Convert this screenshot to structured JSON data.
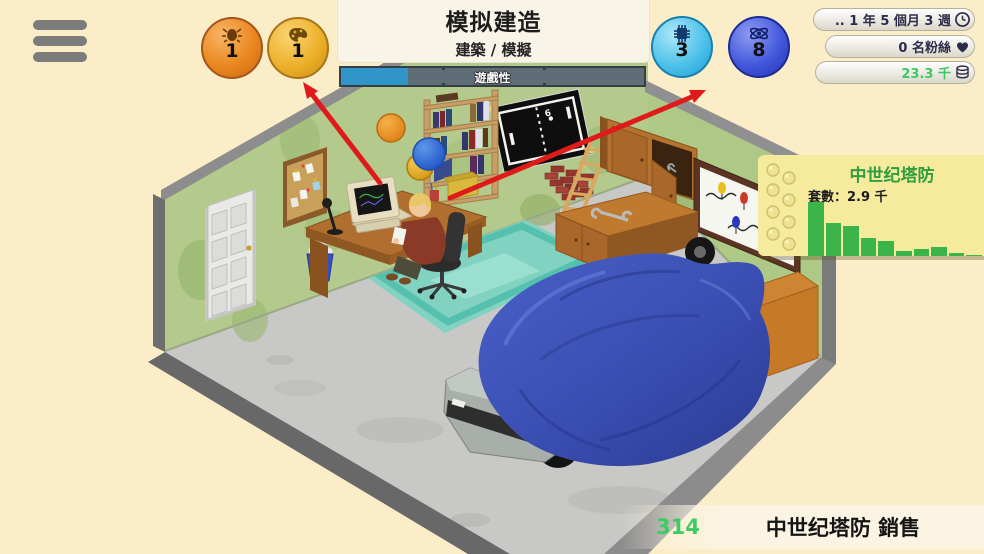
{
  "menu": {
    "hamburger_icon": "menu-icon"
  },
  "header": {
    "game_title": "模拟建造",
    "game_genre": "建築 / 模擬",
    "progress": {
      "label": "遊戲性",
      "percent": 22,
      "fill_color": "#3095c9",
      "track_color": "#5f6e76"
    }
  },
  "badges": {
    "design": {
      "value": "1",
      "icon": "design-icon",
      "color": "#ea871f"
    },
    "graphics": {
      "value": "1",
      "icon": "palette-icon",
      "color": "#edb12b"
    },
    "technology": {
      "value": "3",
      "icon": "chip-icon",
      "color": "#4fc2ea"
    },
    "research": {
      "value": "8",
      "icon": "research-icon",
      "color": "#4458dd"
    }
  },
  "stats": {
    "date": {
      "text": ".. 1 年 5 個月 3 週",
      "icon": "clock-icon"
    },
    "fans": {
      "text": "0 名粉絲",
      "icon": "heart-icon"
    },
    "money": {
      "text": "23.3 千",
      "icon": "coins-icon",
      "color": "#3dc961"
    }
  },
  "tooltip": {
    "title": "中世纪塔防",
    "units_label": "套數：2.9 千",
    "chart": {
      "type": "bar",
      "values": [
        100,
        62,
        56,
        33,
        28,
        10,
        13,
        16,
        5,
        2
      ],
      "color": "#3bb54a",
      "max_height_px": 54
    }
  },
  "sales_banner": {
    "value": "314",
    "label": "中世纪塔防 銷售",
    "value_color": "#3dcb63"
  },
  "scene": {
    "pong_score": "6"
  },
  "colors": {
    "background": "#fcedc9",
    "wall_green": "#b3ca8c",
    "floor_gray": "#c8c8c6",
    "tarp_blue": "#3c50b4",
    "rug_teal": "#82d2c1",
    "arrow_red": "#de1a1a"
  }
}
